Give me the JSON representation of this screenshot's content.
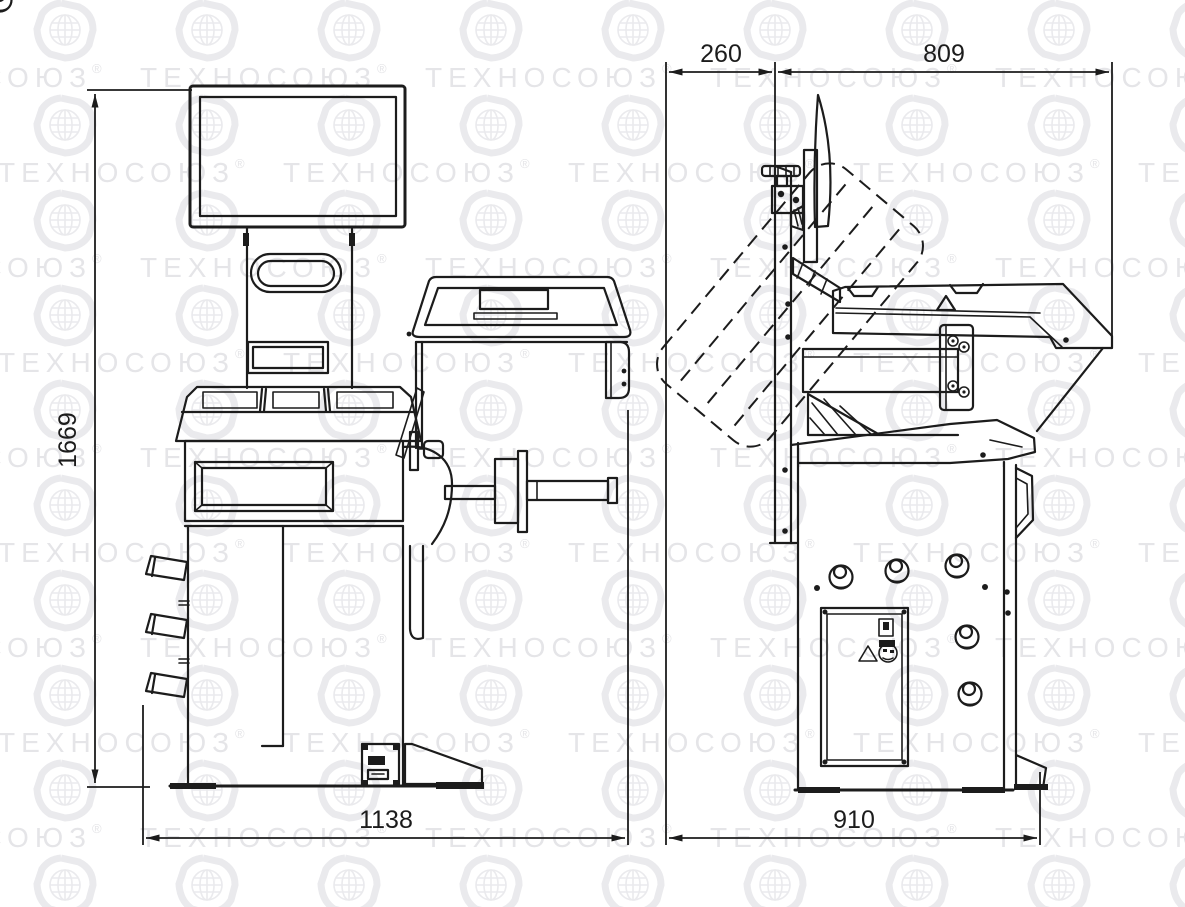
{
  "watermark": {
    "text": "ТЕХНОСОЮЗ",
    "registered_mark": "®",
    "text_color": "#e5e5e8",
    "logo_color": "#eaeaed"
  },
  "drawing": {
    "background_color": "#ffffff",
    "line_color": "#1c1c1c"
  },
  "dimensions": {
    "front_view": {
      "overall_height": "1669",
      "overall_width": "1138"
    },
    "side_view": {
      "guard_offset": "260",
      "guard_reach": "809",
      "overall_depth": "910"
    }
  }
}
